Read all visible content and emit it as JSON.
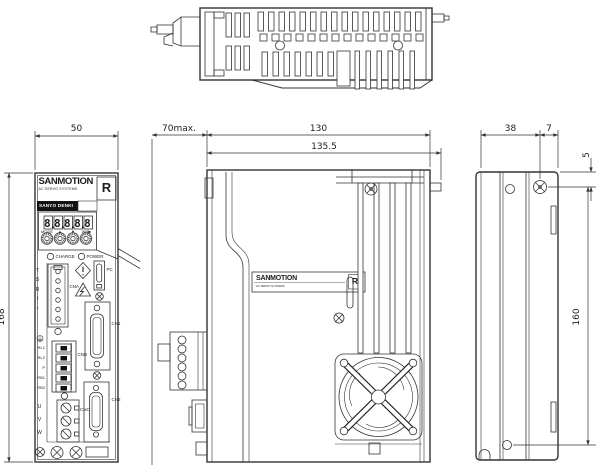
{
  "dims": {
    "front_width": "50",
    "front_height": "168",
    "clearance": "70max.",
    "depth_body": "130",
    "depth_total": "135.5",
    "rear_width": "38",
    "hole_offset": "7",
    "hole_top": "5",
    "mount_pitch": "160"
  },
  "front": {
    "brand": "SANMOTION",
    "brand_sub": "AC SERVO SYSTEMS",
    "logo": "R",
    "maker": "SANYO DENKI",
    "display": "88888",
    "keys": {
      "mode": "MODE",
      "up": "▲",
      "down": "▼",
      "wr": "WR▶"
    },
    "leds": {
      "charge": "CHARGE",
      "power": "POWER"
    },
    "power_terminals": [
      "T",
      "S",
      "R",
      "t",
      "r"
    ],
    "regen_terminals": [
      "RL1",
      "RL2",
      "P",
      "RB1",
      "RB2"
    ],
    "motor_terminals": [
      "U",
      "V",
      "W"
    ],
    "connectors": {
      "cna": "CNA",
      "cnb": "CNB",
      "cnc": "CNC",
      "cn1": "CN1",
      "cn2": "CN2",
      "pc": "PC"
    }
  },
  "side": {
    "plate_brand": "SANMOTION",
    "plate_sub": "AC SERVO SYSTEMS",
    "plate_logo": "R"
  }
}
